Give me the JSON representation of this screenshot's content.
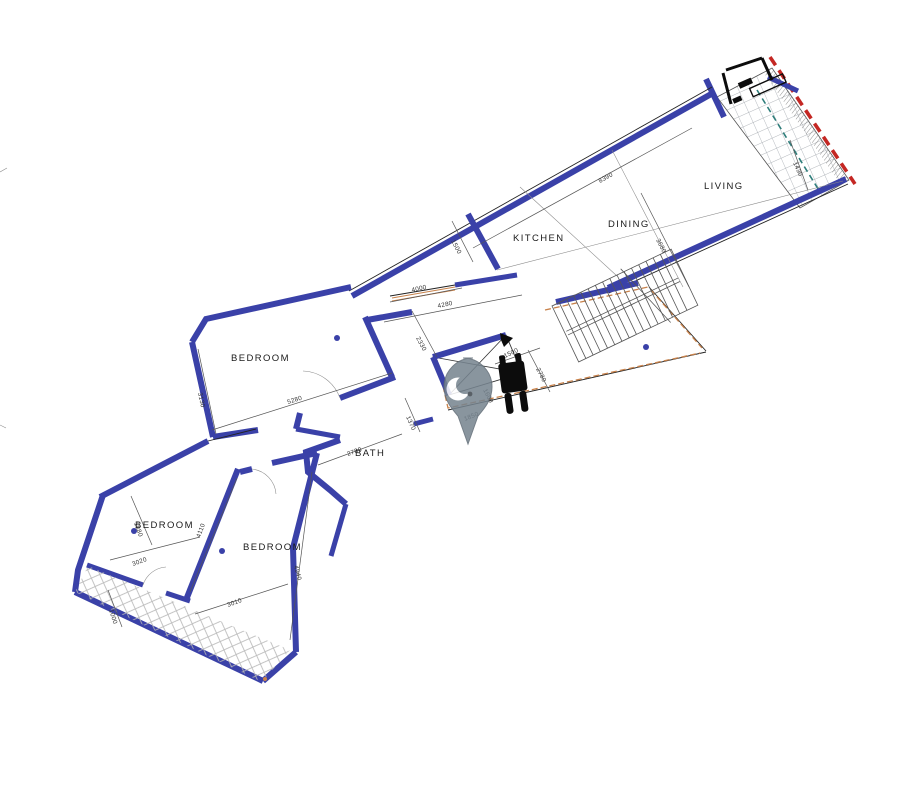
{
  "title": "apartment-floor-plan",
  "labels": {
    "kitchen": "KITCHEN",
    "dining": "DINING",
    "living": "LIVING",
    "bath": "BATH",
    "bedroom1": "BEDROOM",
    "bedroom2": "BEDROOM",
    "bedroom3": "BEDROOM"
  },
  "dims": {
    "d8390": "8390",
    "d3680": "3680",
    "d1430": "1430",
    "d1500k": "1500",
    "d4000": "4000",
    "d4280": "4280",
    "d2330": "2330",
    "d3130": "3130",
    "d5280": "5280",
    "d1370": "1370",
    "d2780bath": "2780",
    "d1500hall": "1500",
    "d2780hall": "2780",
    "d1600": "1600",
    "d1850": "1850",
    "d1880": "1880",
    "d3020": "3020",
    "d4110": "4110",
    "d3010": "3010",
    "d4940": "4940",
    "d1000": "1000"
  },
  "icons": {
    "pin": "location-pin",
    "wheelchair": "wheelchair-accessibility",
    "arrow": "direction-arrow"
  },
  "colors": {
    "wall": "#3a41a8",
    "red": "#c42723",
    "teal": "#2e7d7a",
    "orange": "#c8824b",
    "pin": "#76848f",
    "hatch": "#b0b0b0",
    "dim": "#555555",
    "txt": "#1a1a1a"
  }
}
